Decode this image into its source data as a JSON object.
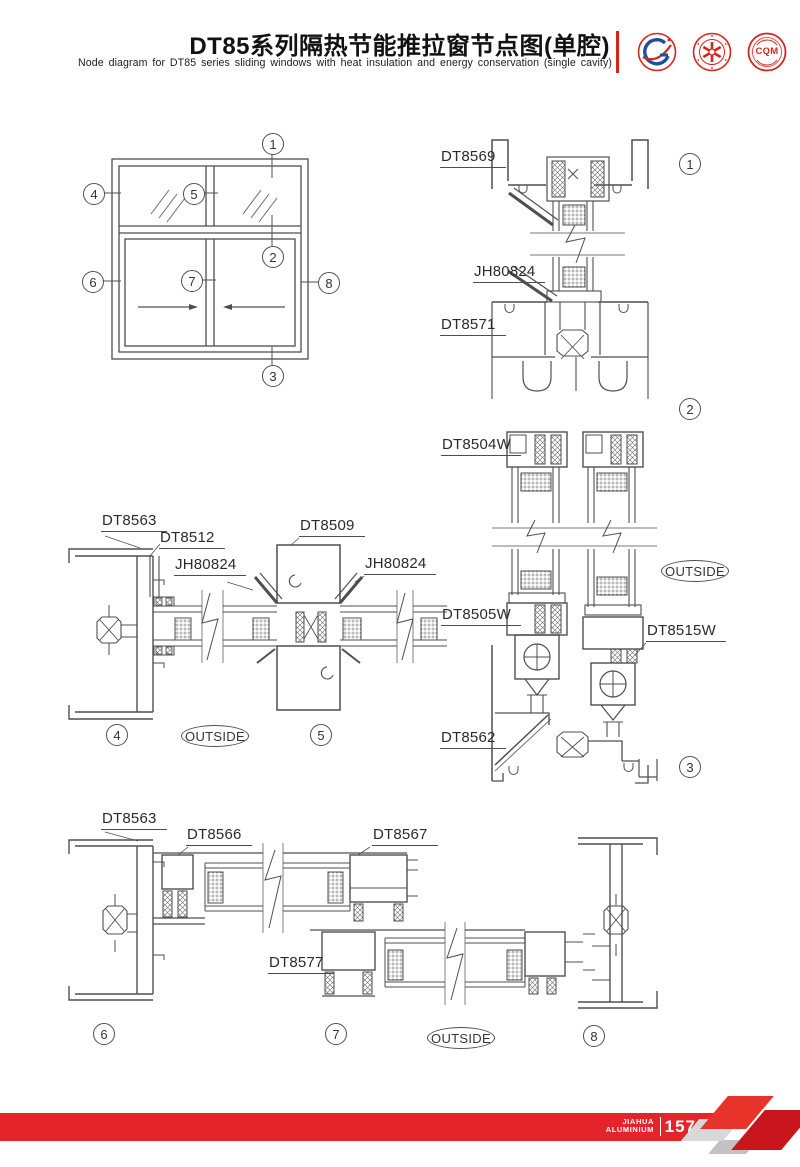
{
  "header": {
    "title_cn": "DT85系列隔热节能推拉窗节点图(单腔)",
    "title_en": "Node diagram for DT85 series sliding windows with heat insulation and energy conservation (single cavity)",
    "logos": [
      {
        "name": "gt-aluminium-logo"
      },
      {
        "name": "quality-seal-logo"
      },
      {
        "name": "cqm-certification-logo",
        "text": "CQM"
      }
    ]
  },
  "markers": {
    "s1": "1",
    "s2": "2",
    "s3": "3",
    "s4": "4",
    "s5": "5",
    "s6": "6",
    "s7": "7",
    "s8": "8"
  },
  "labels": {
    "dt8569": "DT8569",
    "dt8571": "DT8571",
    "dt8504w": "DT8504W",
    "dt8505w": "DT8505W",
    "dt8515w": "DT8515W",
    "dt8562": "DT8562",
    "dt8563": "DT8563",
    "dt8512": "DT8512",
    "dt8509": "DT8509",
    "dt8566": "DT8566",
    "dt8567": "DT8567",
    "dt8577": "DT8577",
    "jh80824": "JH80824",
    "outside": "OUTSIDE"
  },
  "footer": {
    "brand_line1": "JIAHUA",
    "brand_line2": "ALUMINIUM",
    "page_number": "157"
  }
}
